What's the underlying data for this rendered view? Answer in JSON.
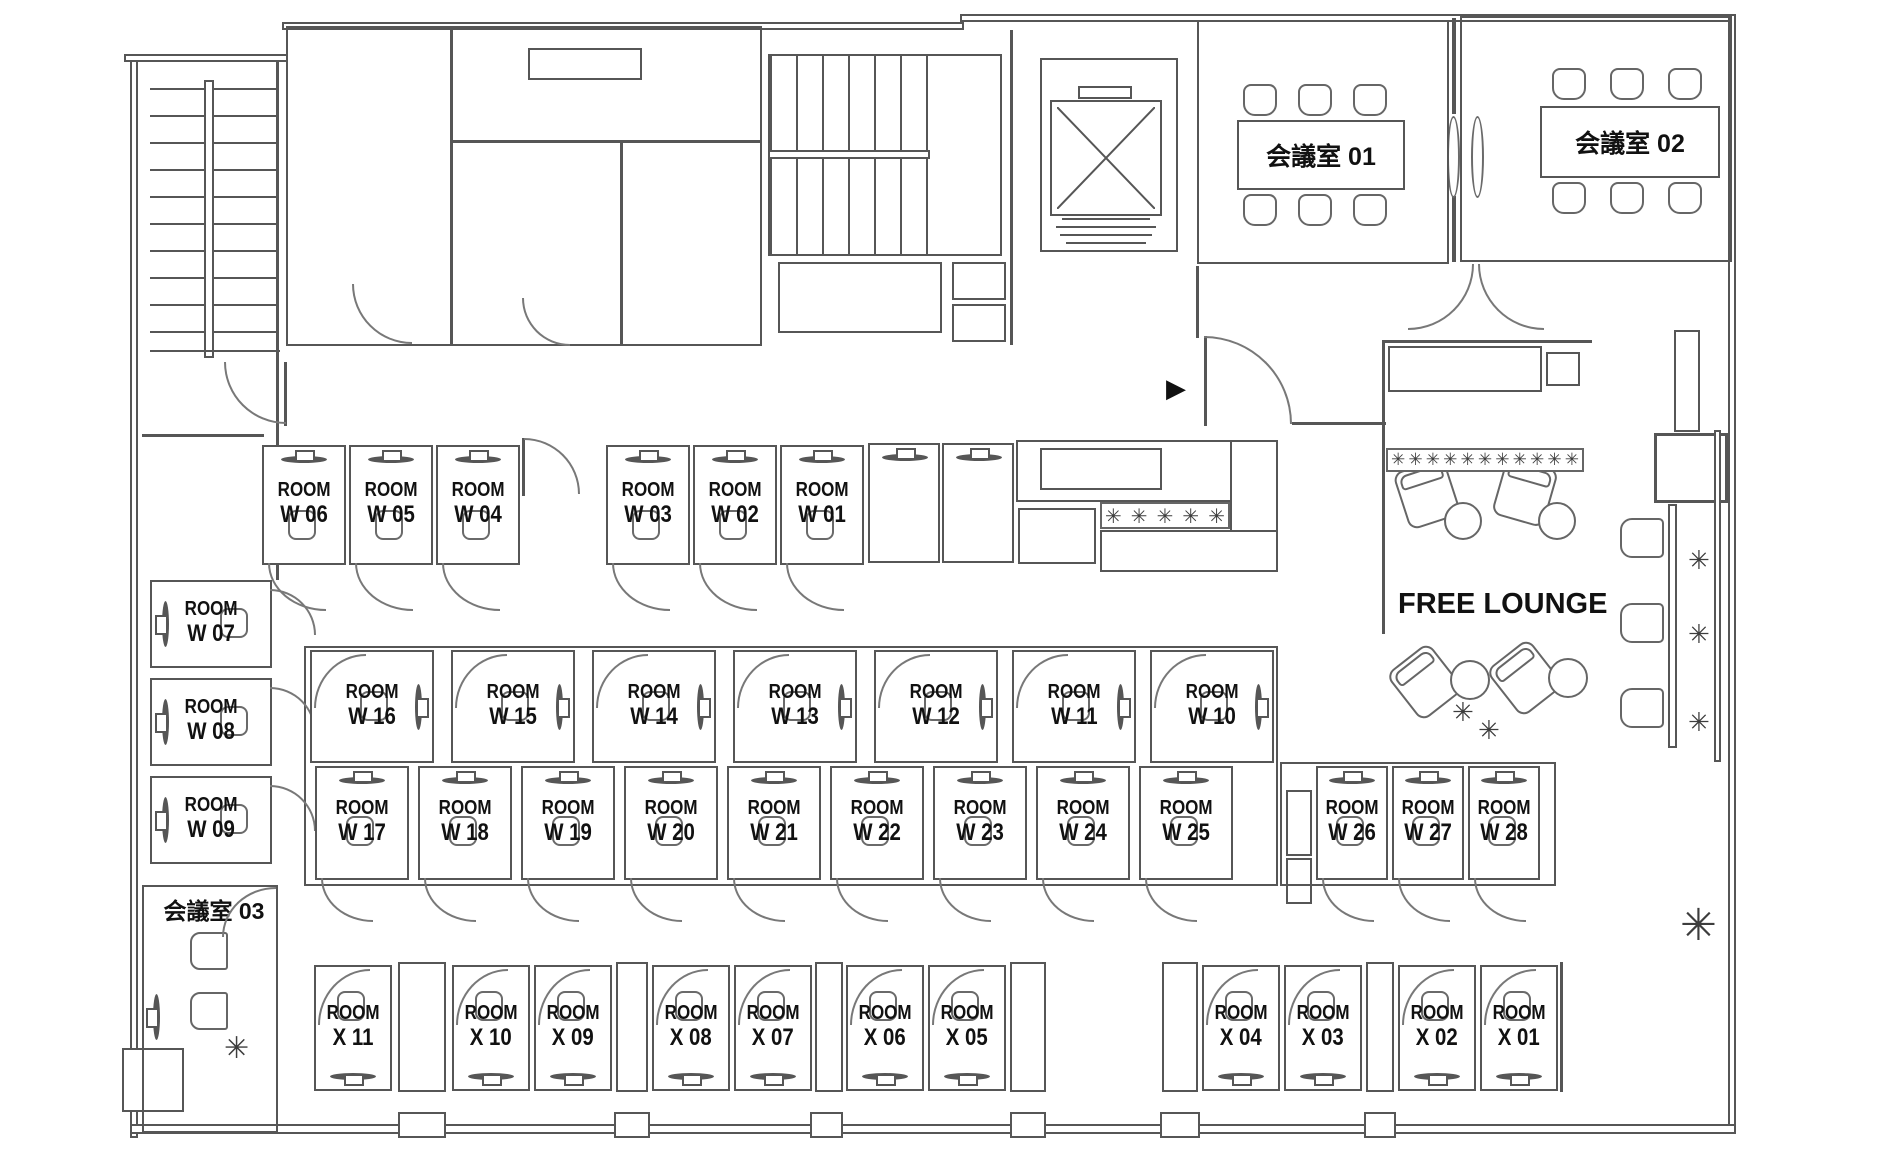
{
  "floor_plan": {
    "room_word": "ROOM",
    "w_rooms": [
      "W 01",
      "W 02",
      "W 03",
      "W 04",
      "W 05",
      "W 06",
      "W 07",
      "W 08",
      "W 09",
      "W 10",
      "W 11",
      "W 12",
      "W 13",
      "W 14",
      "W 15",
      "W 16",
      "W 17",
      "W 18",
      "W 19",
      "W 20",
      "W 21",
      "W 22",
      "W 23",
      "W 24",
      "W 25",
      "W 26",
      "W 27",
      "W 28"
    ],
    "x_rooms": [
      "X 01",
      "X 02",
      "X 03",
      "X 04",
      "X 05",
      "X 06",
      "X 07",
      "X 08",
      "X 09",
      "X 10",
      "X 11"
    ],
    "meeting_rooms": [
      {
        "label": "会議室 01"
      },
      {
        "label": "会議室 02"
      },
      {
        "label": "会議室 03"
      }
    ],
    "lounge_label": "FREE LOUNGE",
    "icons": {
      "plant": "✳",
      "entrance_arrow": "▶"
    },
    "colors": {
      "wall_line": "#565656",
      "text": "#111111",
      "background": "#ffffff"
    }
  }
}
